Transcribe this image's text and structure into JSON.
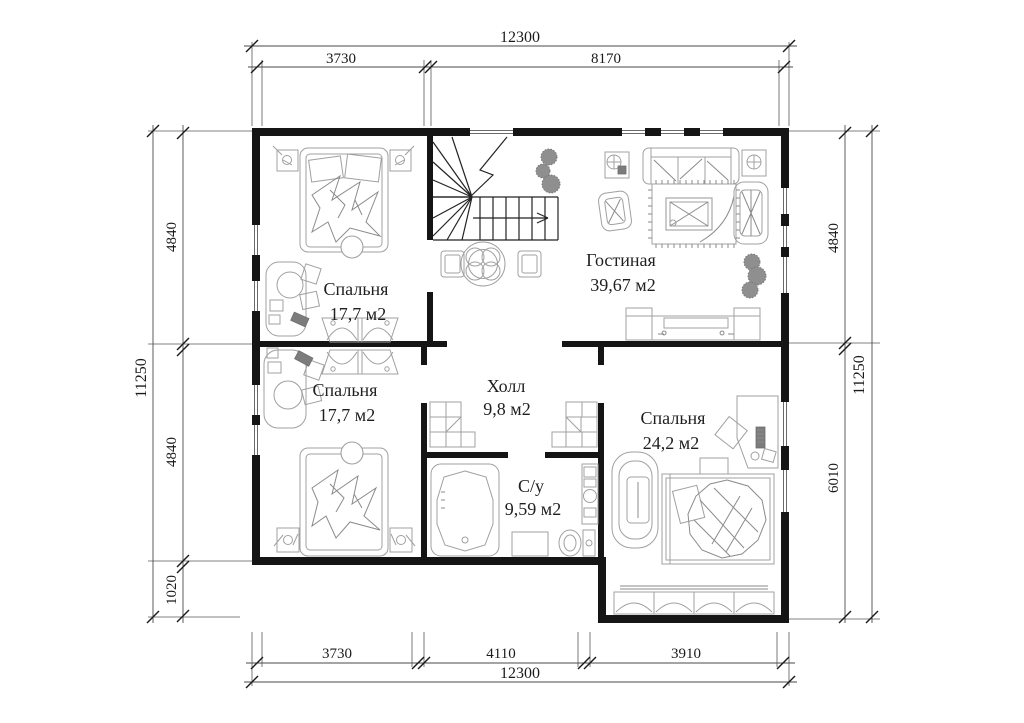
{
  "plan": {
    "type": "floor-plan",
    "colors": {
      "background": "#ffffff",
      "wall": "#151515",
      "furniture": "#a0a0a0",
      "dimension_lines": "#4a4a4a",
      "text": "#1f1f1f"
    },
    "rooms": {
      "bedroom1": {
        "name": "Спальня",
        "area": "17,7 м2"
      },
      "living": {
        "name": "Гостиная",
        "area": "39,67 м2"
      },
      "bedroom2": {
        "name": "Спальня",
        "area": "17,7 м2"
      },
      "hall": {
        "name": "Холл",
        "area": "9,8 м2"
      },
      "bathroom": {
        "name": "С/у",
        "area": "9,59 м2"
      },
      "bedroom3": {
        "name": "Спальня",
        "area": "24,2 м2"
      }
    },
    "dimensions": {
      "top": {
        "total": "12300",
        "seg1": "3730",
        "seg2": "8170"
      },
      "bottom": {
        "total": "12300",
        "seg1": "3730",
        "seg2": "4110",
        "seg3": "3910"
      },
      "left": {
        "total": "11250",
        "seg1": "4840",
        "seg2": "4840",
        "seg3": "1020"
      },
      "right": {
        "total": "11250",
        "seg1": "4840",
        "seg2": "6010"
      }
    }
  }
}
